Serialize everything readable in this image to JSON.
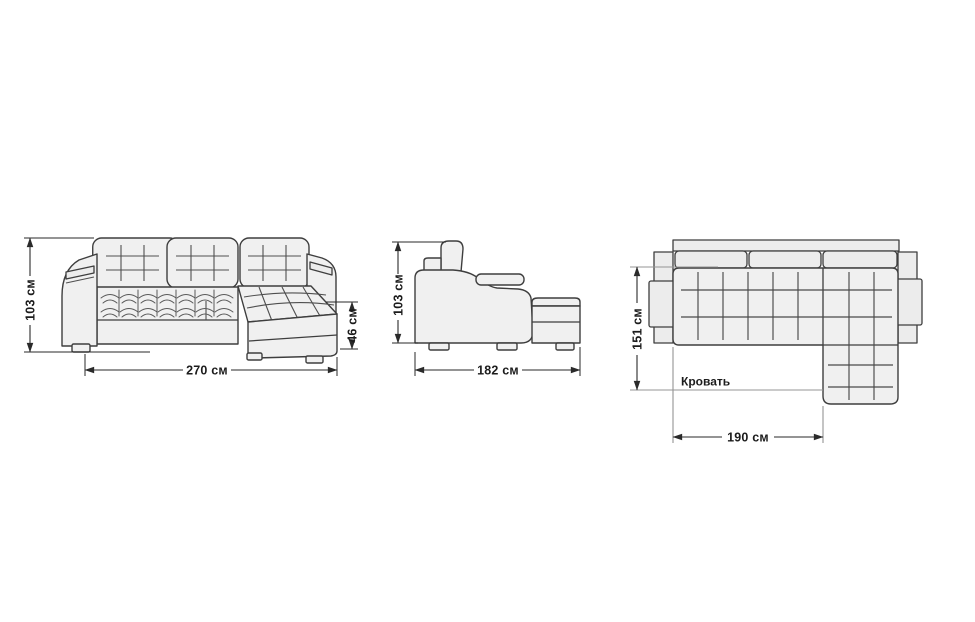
{
  "page": {
    "background_color": "#ffffff"
  },
  "colors": {
    "upholstery_fill": "#f0f0f0",
    "outline": "#3e3e3e",
    "stitch_lines": "#555555",
    "dimension_lines": "#2a2a2a",
    "bed_outline": "#949494",
    "label_text": "#1c1c1c"
  },
  "views": {
    "front": {
      "height_dim": "103 см",
      "width_dim": "270 см",
      "seat_height_dim": "46 см"
    },
    "side": {
      "height_dim": "103 см",
      "depth_dim": "182 см"
    },
    "top": {
      "sleeping_width_dim": "151 см",
      "sleeping_length_dim": "190 см",
      "bed_area_label": "Кровать"
    }
  }
}
